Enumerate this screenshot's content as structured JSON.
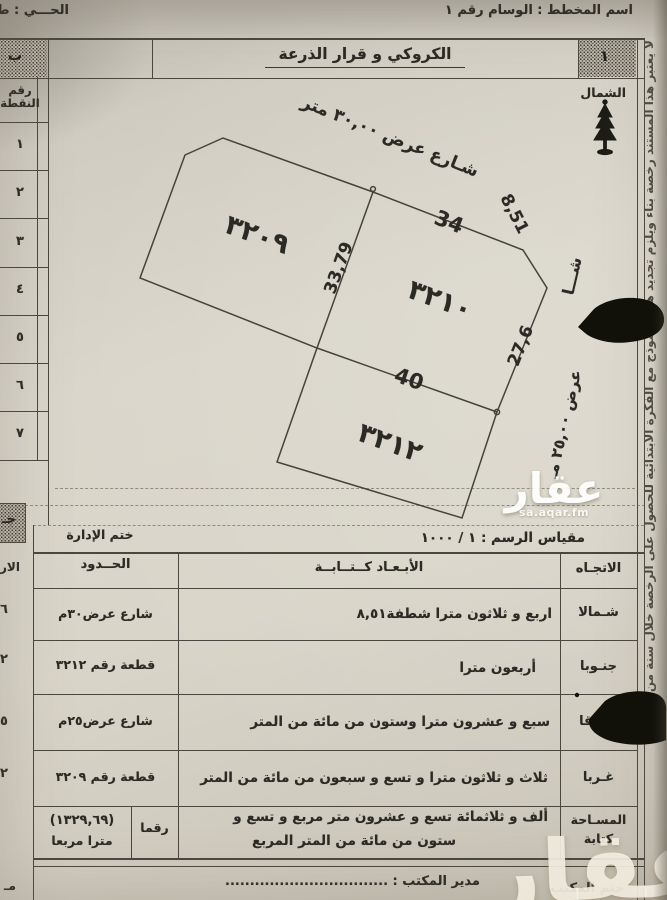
{
  "meta": {
    "plan_name": "اسم المخطط : الوسام رقم ١",
    "district": "الحـــي : ط"
  },
  "title": "الكروكي و قرار الذرعة",
  "corners": {
    "right": "١",
    "left": "ب",
    "lower_left": "جـ"
  },
  "north_label": "الشمال",
  "point_table": {
    "header_line1": "رقم",
    "header_line2": "النقطة",
    "points": [
      "١",
      "٢",
      "٣",
      "٤",
      "٥",
      "٦",
      "٧"
    ]
  },
  "cut_column": {
    "header": "الار",
    "row_values": [
      "٦",
      "٢",
      "٥",
      "٢"
    ],
    "footer": "مـ"
  },
  "diagram": {
    "street_top": "شـارع عرض ٣٠,٠٠ متر",
    "street_right_top": "شـــا",
    "street_right_bottom": "عرض ٢٥,٠٠ مـ",
    "plot_numbers": {
      "p3209": "٣٢٠٩",
      "p3210": "٣٢١٠",
      "p3212": "٣٢١٢"
    },
    "dimensions": {
      "north_edge": "34",
      "chamfer": "8,51",
      "west_divider": "33,79",
      "south_edge": "40",
      "east_edge": "27,6"
    }
  },
  "stamp_row": {
    "admin_stamp": "ختم الإدارة",
    "scale": "مقياس الرسم : ١ / ١٠٠٠"
  },
  "table": {
    "headers": {
      "direction": "الاتجـاه",
      "dims": "الأبـعـاد كــتــابــة",
      "bounds": "الحــدود"
    },
    "rows": [
      {
        "direction": "شـمالا",
        "dims": "اربع و ثلاثون مترا شطفة٨,٥١",
        "bound": "شارع عرض٣٠م"
      },
      {
        "direction": "جنـوبا",
        "dims": "أربعون مترا",
        "bound": "قطعة رقم ٣٢١٢"
      },
      {
        "direction": "شـرقا",
        "dims": "سبع و عشرون مترا وستون من مائة من المتر",
        "bound": "شارع عرض٢٥م"
      },
      {
        "direction": "غـربا",
        "dims": "ثلاث و ثلاثون مترا و تسع و سبعون من مائة من المتر",
        "bound": "قطعة رقم ٣٢٠٩"
      }
    ],
    "area_row": {
      "label1": "المسـاحة",
      "label2": "كتابة",
      "text1": "ألف و ثلاثمائة تسع و عشرون متر مربع و تسع و",
      "text2": "ستون من مائة من المتر المربع",
      "figures_label": "رقما",
      "value": "(١٣٢٩,٦٩)",
      "value_unit": "مترا مربعا"
    }
  },
  "footer": {
    "office_stamp": "ختم المكتب",
    "manager": "مدير المكتب : ................................."
  },
  "margin_note": "لا يعتبر هذا المستند رخصة بناء ويلزم تجديد هذا النموذج مع الفكرة الابتدائية للحصول على الرخصة خلال سنة من تاريخه",
  "watermark": {
    "name": "عقار",
    "url": "sa.aqar.fm",
    "big": "عقار"
  },
  "colors": {
    "paper": "#d6d2c7",
    "ink": "#2c2a24",
    "line": "#4a473e",
    "hatch_bg": "#bfbaad"
  }
}
